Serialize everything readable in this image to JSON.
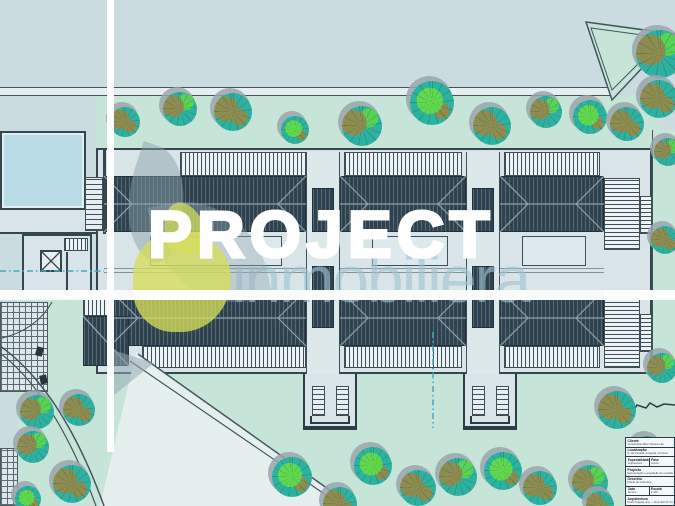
{
  "watermark": {
    "title": "PROJECT",
    "subtitle": "inmobiliera",
    "title_color": "#ffffff",
    "subtitle_color": "#a0c3d3",
    "logo_pear_color": "#d5de5a",
    "logo_leaf_color": "#93a7b3"
  },
  "palette": {
    "background": "#cbdce1",
    "green_area": "#c6e4d8",
    "roof_dark": "#2e434f",
    "pool_water": "#b9dbe6",
    "tree_canopy": "#2eb1a1",
    "tree_olive": "#8e8c4f",
    "tree_bright": "#57d254",
    "line_dark": "#36464f",
    "dash_blue": "#4aa3c2"
  },
  "title_block": {
    "rows": [
      {
        "label": "Cliente",
        "value": "Construções Belo Oliveira Lda"
      },
      {
        "label": "Localização",
        "value": "R. da Canada, Amiguda, Corroios"
      },
      {
        "cols": [
          {
            "label": "Especialidade",
            "value": "Arquitectura"
          },
          {
            "label": "Fase",
            "value": "Licenc."
          }
        ]
      },
      {
        "label": "Projecto",
        "value": "Recuperação e ampliação de moradia"
      },
      {
        "label": "Desenho",
        "value": "Planta de Cobertura"
      },
      {
        "cols": [
          {
            "label": "Data",
            "value": "Janeiro"
          },
          {
            "label": "Escala",
            "value": "1:100"
          }
        ]
      },
      {
        "label": "Arquitectura",
        "value": "Pedro Sapata, Arq. — Rua Góis Nº 11 r/c"
      }
    ]
  },
  "trees": [
    {
      "x": 125,
      "y": 122,
      "r": 15,
      "v": 0
    },
    {
      "x": 180,
      "y": 109,
      "r": 17,
      "v": 1
    },
    {
      "x": 233,
      "y": 112,
      "r": 19,
      "v": 0
    },
    {
      "x": 295,
      "y": 130,
      "r": 14,
      "v": 2
    },
    {
      "x": 362,
      "y": 126,
      "r": 20,
      "v": 1
    },
    {
      "x": 432,
      "y": 103,
      "r": 22,
      "v": 2
    },
    {
      "x": 492,
      "y": 126,
      "r": 19,
      "v": 0
    },
    {
      "x": 546,
      "y": 112,
      "r": 16,
      "v": 1
    },
    {
      "x": 590,
      "y": 117,
      "r": 17,
      "v": 2
    },
    {
      "x": 627,
      "y": 124,
      "r": 17,
      "v": 0
    },
    {
      "x": 660,
      "y": 54,
      "r": 24,
      "v": 1
    },
    {
      "x": 659,
      "y": 99,
      "r": 19,
      "v": 0
    },
    {
      "x": 668,
      "y": 152,
      "r": 14,
      "v": 1
    },
    {
      "x": 665,
      "y": 240,
      "r": 14,
      "v": 0
    },
    {
      "x": 662,
      "y": 368,
      "r": 15,
      "v": 1
    },
    {
      "x": 37,
      "y": 412,
      "r": 17,
      "v": 1
    },
    {
      "x": 79,
      "y": 410,
      "r": 16,
      "v": 0
    },
    {
      "x": 33,
      "y": 447,
      "r": 16,
      "v": 1
    },
    {
      "x": 72,
      "y": 484,
      "r": 19,
      "v": 0
    },
    {
      "x": 28,
      "y": 499,
      "r": 13,
      "v": 2
    },
    {
      "x": 292,
      "y": 477,
      "r": 20,
      "v": 2
    },
    {
      "x": 340,
      "y": 504,
      "r": 17,
      "v": 0
    },
    {
      "x": 373,
      "y": 466,
      "r": 19,
      "v": 2
    },
    {
      "x": 418,
      "y": 488,
      "r": 18,
      "v": 0
    },
    {
      "x": 458,
      "y": 477,
      "r": 19,
      "v": 1
    },
    {
      "x": 503,
      "y": 471,
      "r": 19,
      "v": 2
    },
    {
      "x": 540,
      "y": 488,
      "r": 17,
      "v": 0
    },
    {
      "x": 590,
      "y": 483,
      "r": 18,
      "v": 1
    },
    {
      "x": 617,
      "y": 410,
      "r": 19,
      "v": 0
    },
    {
      "x": 647,
      "y": 452,
      "r": 16,
      "v": 1
    },
    {
      "x": 600,
      "y": 505,
      "r": 14,
      "v": 0
    }
  ]
}
